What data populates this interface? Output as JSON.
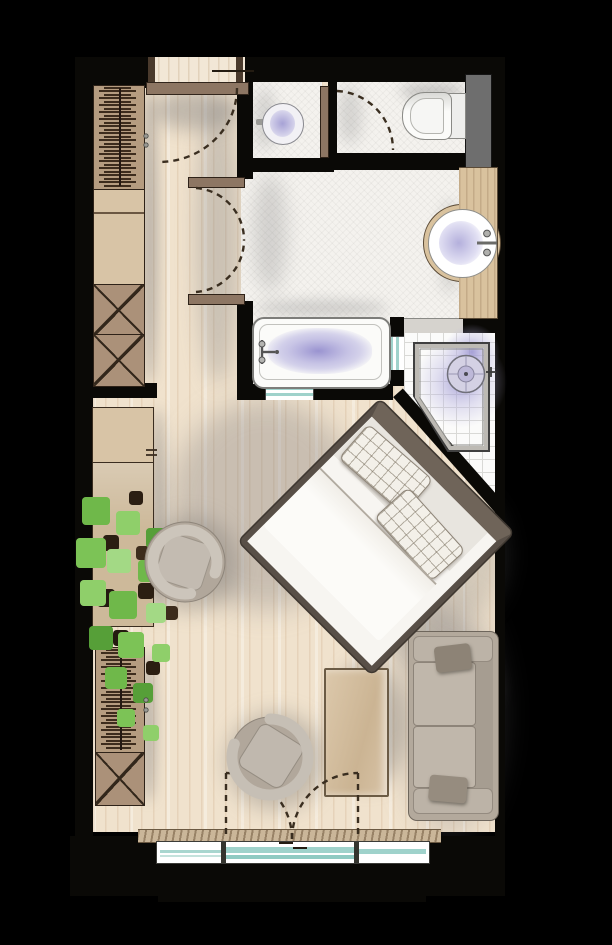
{
  "meta": {
    "kind": "floor-plan",
    "label": "hotel-room-top-view-floor-plan"
  },
  "palette": {
    "bg": "#000000",
    "wall": "#0a0906",
    "wood": "#f0e2cd",
    "bathFloor": "#f4f2ee",
    "tile": "#fbfbfa",
    "tan": "#c9b091",
    "tanDark": "#ab9179",
    "tanLight": "#d8c4a6",
    "doorBrown": "#8d7663",
    "frameDark": "#2e2218",
    "glassTeal": "#9fd2cb",
    "water": "#938cce",
    "fixtureWhite": "#fbfbf9",
    "fixtureLine": "#8a8a86",
    "sofaBody": "#b3a99c",
    "sofaDark": "#8d8376",
    "bedFrame": "#584f47",
    "bedHead": "#6f6459",
    "bedLinen": "#f7f5f1",
    "chairBody": "#b1a79b",
    "chairRing": "#ccc5bb",
    "counterWood": "#d9c29e",
    "grayBlock": "#6e6e6e",
    "plantGreen": "#74bb4e",
    "plantDark": "#2b1e12",
    "curtain": "#cab699"
  },
  "rooms": [
    {
      "name": "entry"
    },
    {
      "name": "hallway"
    },
    {
      "name": "bidet-room"
    },
    {
      "name": "wc"
    },
    {
      "name": "bathroom"
    },
    {
      "name": "shower"
    },
    {
      "name": "bedroom"
    },
    {
      "name": "balcony-window"
    }
  ],
  "fixtures": [
    {
      "name": "entry-door"
    },
    {
      "name": "bathroom-double-door"
    },
    {
      "name": "wc-door"
    },
    {
      "name": "balcony-french-door"
    },
    {
      "name": "bathtub"
    },
    {
      "name": "corner-shower"
    },
    {
      "name": "vanity-basin"
    },
    {
      "name": "toilet"
    },
    {
      "name": "bidet"
    },
    {
      "name": "glass-partition"
    }
  ],
  "furniture": [
    {
      "name": "wardrobe-hangers-top"
    },
    {
      "name": "dresser"
    },
    {
      "name": "shelf-box-1"
    },
    {
      "name": "shelf-box-2"
    },
    {
      "name": "sideboard"
    },
    {
      "name": "potted-plant"
    },
    {
      "name": "wardrobe-hangers-bottom"
    },
    {
      "name": "shelf-box-3"
    },
    {
      "name": "double-bed"
    },
    {
      "name": "swivel-chair-1"
    },
    {
      "name": "swivel-chair-2"
    },
    {
      "name": "desk-table"
    },
    {
      "name": "sofa"
    }
  ]
}
